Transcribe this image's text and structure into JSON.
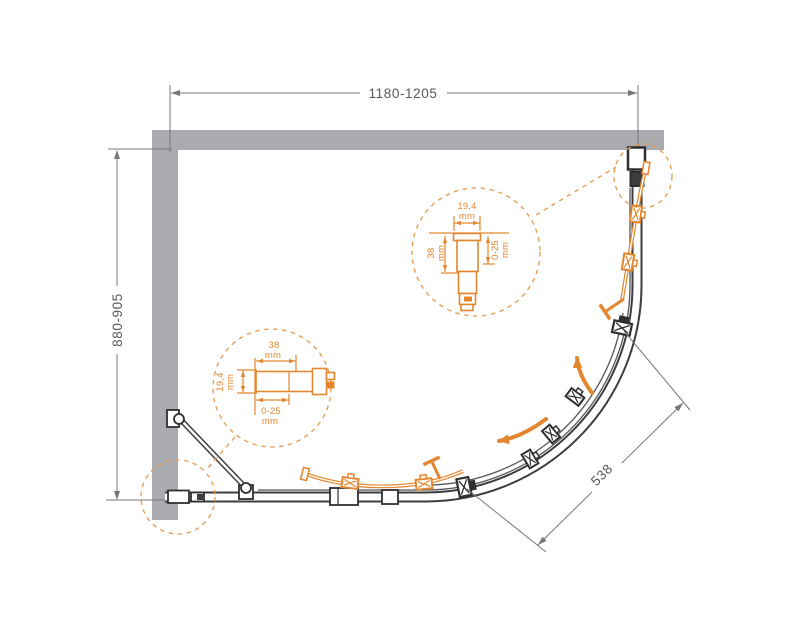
{
  "diagram": {
    "dimensions": {
      "width": "1180-1205",
      "depth": "880-905",
      "entry": "538"
    },
    "detail_top": {
      "width": "19,4",
      "width_unit": "mm",
      "length": "38",
      "length_unit": "mm",
      "adjustment": "0-25",
      "adjustment_unit": "mm"
    },
    "detail_bottom": {
      "length": "38",
      "length_unit": "mm",
      "width": "19,4",
      "width_unit": "mm",
      "adjustment": "0-25",
      "adjustment_unit": "mm"
    },
    "colors": {
      "accent_orange": "#e2872f",
      "wall_gray": "#aaabaf",
      "line_dark": "#3d3d40",
      "dim_gray": "#77777b"
    }
  }
}
